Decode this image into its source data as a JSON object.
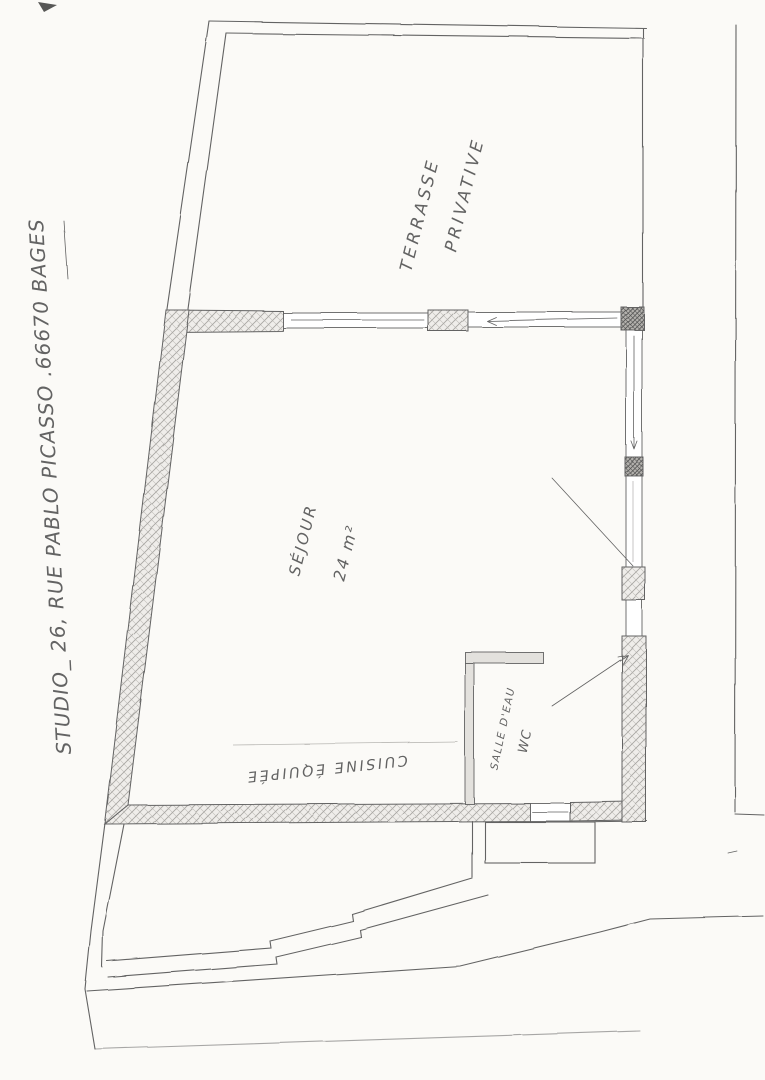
{
  "document": {
    "kind": "hand-drawn floor plan sketch",
    "title": "STUDIO_ 26, RUE PABLO PICASSO .66670 BAGES"
  },
  "rooms": {
    "terrace": {
      "line1": "TERRASSE",
      "line2": "PRIVATIVE"
    },
    "living": {
      "name": "SÉJOUR",
      "area": "24 m²"
    },
    "kitchen": {
      "name": "CUISINE ÉQUIPÉE"
    },
    "bathroom": {
      "line1": "SALLE D'EAU",
      "line2": "WC"
    }
  },
  "colors": {
    "paper": "#fbfaf7",
    "pencil": "#636363",
    "pencil_light": "#a8a6a2",
    "wall_fill": "#efedea",
    "post_fill": "#b3b1ad"
  }
}
